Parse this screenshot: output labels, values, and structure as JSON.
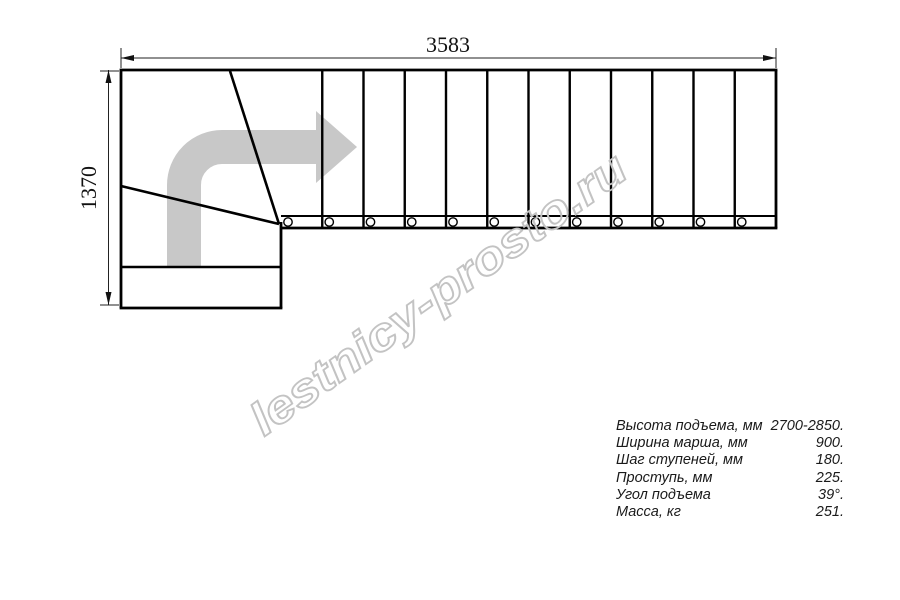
{
  "drawing": {
    "tread_count": 12,
    "width_dimension_mm": "3583",
    "height_dimension_mm": "1370"
  },
  "watermark": {
    "text": "lestnicy-prosto.ru"
  },
  "specs": {
    "rows": [
      {
        "label": "Высота подъема, мм",
        "value": "2700-2850."
      },
      {
        "label": "Ширина марша, мм",
        "value": "900."
      },
      {
        "label": "Шаг ступеней, мм",
        "value": "180."
      },
      {
        "label": "Проступь, мм",
        "value": "225."
      },
      {
        "label": "Угол подъема",
        "value": "39°."
      },
      {
        "label": "Масса, кг",
        "value": "251."
      }
    ]
  },
  "colors": {
    "line": "#000000",
    "arrow_gray": "#c8c8c8",
    "watermark_gray": "#c3c3c3"
  }
}
